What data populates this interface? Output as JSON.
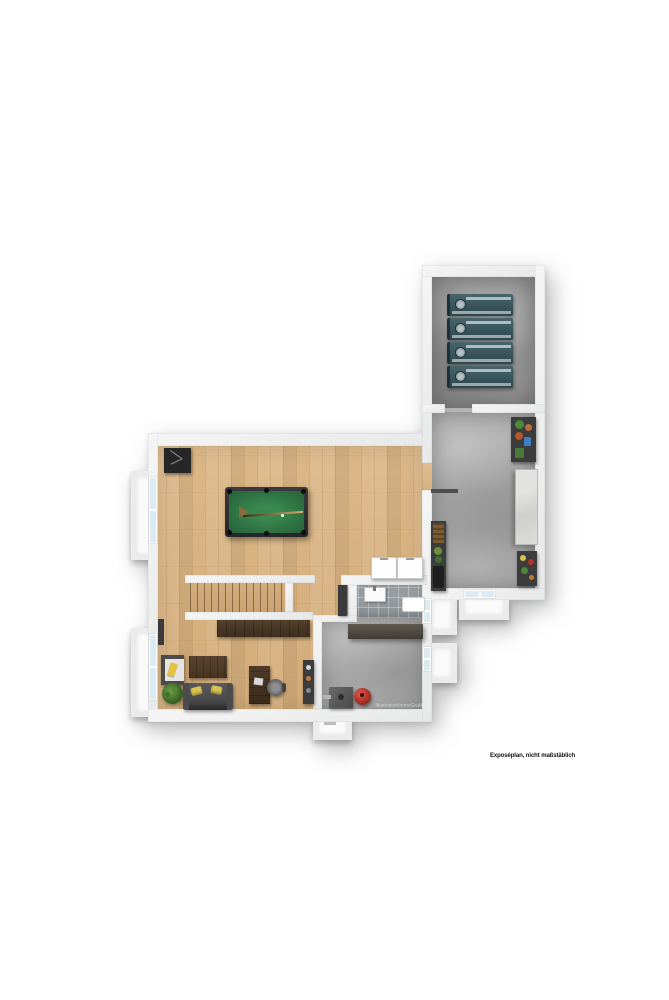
{
  "caption": "Exposéplan, nicht maßstäblich",
  "watermark": "IllustrationImmoGrafik",
  "floorplan": {
    "type": "basement-exposé-plan",
    "rooms": [
      {
        "name": "hobby-room",
        "floor": "wood",
        "furniture": [
          "pool-table",
          "dartboard-cabinet",
          "washing-machine",
          "dryer"
        ]
      },
      {
        "name": "stairs",
        "direction": "right"
      },
      {
        "name": "office-corner",
        "floor": "wood",
        "furniture": [
          "sofa",
          "pillows",
          "coffee-table",
          "desk",
          "office-chair",
          "wall-shelf",
          "plant",
          "sideboard",
          "storage-rack",
          "radiator"
        ]
      },
      {
        "name": "bathroom",
        "floor": "tile",
        "furniture": [
          "sink",
          "shower-tray"
        ]
      },
      {
        "name": "utility-room",
        "floor": "concrete",
        "furniture": [
          "workbench",
          "boiler",
          "pressure-tank"
        ]
      },
      {
        "name": "corridor",
        "floor": "concrete",
        "furniture": [
          "tall-shelf",
          "pot-shelf",
          "console-table",
          "small-shelf"
        ]
      },
      {
        "name": "storage-room",
        "floor": "concrete",
        "furniture": [
          "storage-unit",
          "storage-unit",
          "storage-unit",
          "storage-unit"
        ]
      }
    ],
    "colors": {
      "wall": "#eff0f0",
      "wood_floor": "#d7b283",
      "concrete_floor": "#a8a8a8",
      "tile_floor": "#98a0a4",
      "window_glass": "#dcebf2",
      "pool_felt": "#2f7040",
      "storage_unit_teal": "#37555c",
      "pressure_tank_red": "#c23b2e",
      "pillow_yellow": "#d9c24f",
      "furniture_brown": "#4a3726"
    }
  }
}
